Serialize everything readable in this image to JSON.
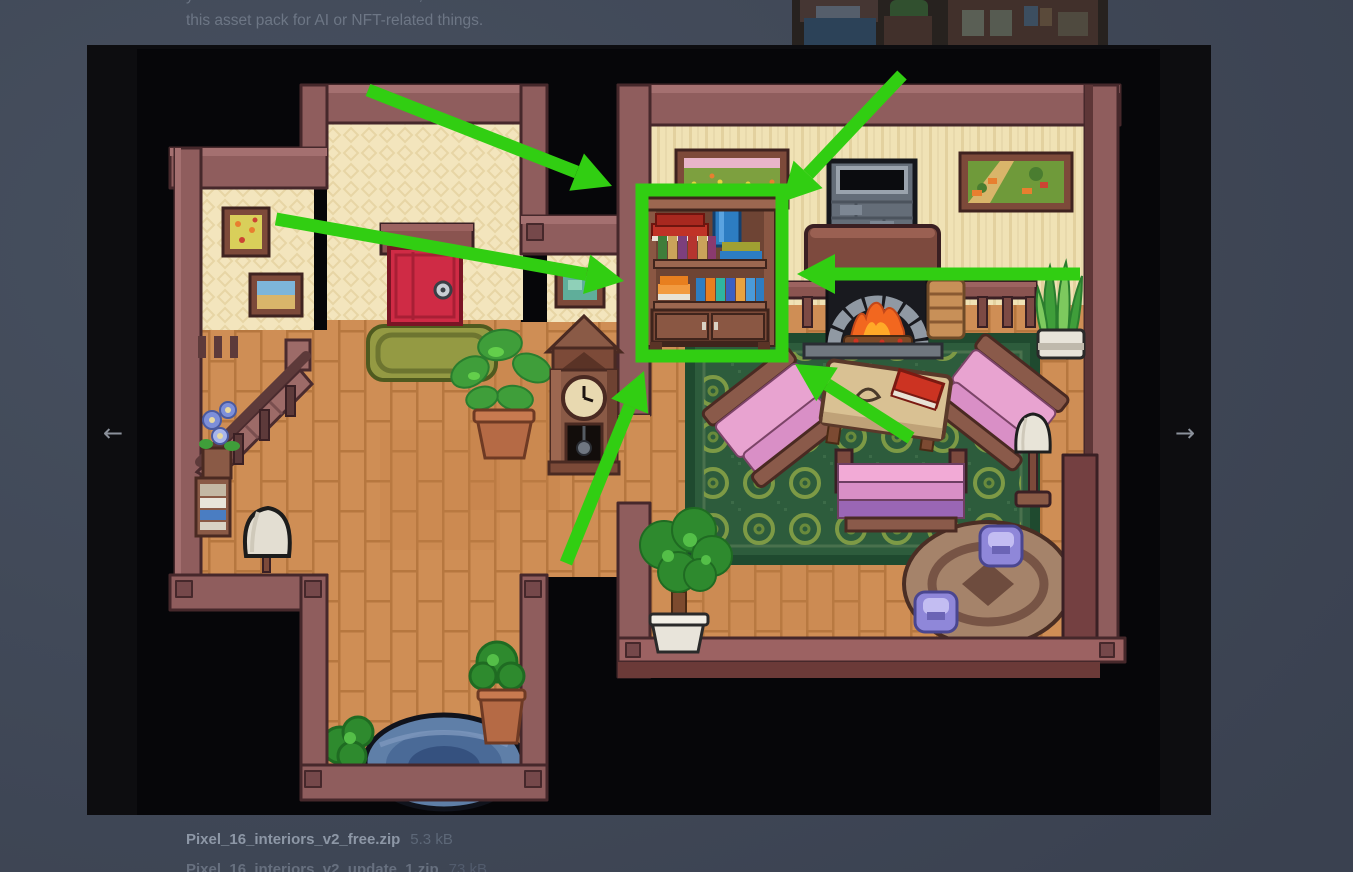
{
  "license": {
    "line1_pre": "you ",
    "line1_bold1": "cannot",
    "line1_mid": " resell or redistribute it, even if modified. You ",
    "line1_bold2": "cannot",
    "line1_end": " use",
    "line2": "this asset pack for AI or NFT-related things."
  },
  "lightbox": {
    "prev_label": "←",
    "next_label": "→"
  },
  "files": [
    {
      "name": "Pixel_16_interiors_v2_free.zip",
      "size": "5.3 kB"
    },
    {
      "name": "Pixel_16_interiors_v2_update_1.zip",
      "size": "73 kB"
    }
  ],
  "annotations": {
    "color": "#31ce12",
    "shaft_width": 13,
    "head_length": 38,
    "head_half_width": 20,
    "rect": {
      "x": 642,
      "y": 190,
      "w": 140,
      "h": 166,
      "stroke": 13
    },
    "arrows": [
      {
        "x1": 368,
        "y1": 90,
        "x2": 612,
        "y2": 186
      },
      {
        "x1": 276,
        "y1": 219,
        "x2": 624,
        "y2": 281
      },
      {
        "x1": 902,
        "y1": 75,
        "x2": 782,
        "y2": 202
      },
      {
        "x1": 1080,
        "y1": 274,
        "x2": 797,
        "y2": 274
      },
      {
        "x1": 911,
        "y1": 438,
        "x2": 795,
        "y2": 364
      },
      {
        "x1": 566,
        "y1": 563,
        "x2": 644,
        "y2": 371
      }
    ]
  },
  "scene": {
    "description": "Top-down pixel-art house interior: hall with stairs, red door, grandfather clock; living room with bookshelf (highlighted by green box and arrows), fireplace, paintings, armchairs, table, sofa, green circle rug, round rug with purple poufs, plants; pond nook at bottom",
    "highlighted_object": "bookshelf",
    "objects": [
      "stairs",
      "blue-flowers",
      "side-shelf",
      "lamp",
      "framed-picture",
      "framed-picture",
      "red-door",
      "door-rug",
      "potted-plant",
      "grandfather-clock",
      "green-picture",
      "bookshelf",
      "flower-painting",
      "fireplace",
      "landscape-painting",
      "railing",
      "firewood",
      "snake-plant",
      "green-rug",
      "armchair",
      "armchair",
      "coffee-table",
      "red-book",
      "sofa",
      "floor-lamp",
      "round-rug",
      "pouf",
      "pouf",
      "potted-tree",
      "bush",
      "pond",
      "potted-bush"
    ]
  },
  "colors": {
    "page_bg": "#414a59",
    "panel_bg": "#0d0d10",
    "image_bg": "#060609",
    "annotation_green": "#31ce12"
  }
}
